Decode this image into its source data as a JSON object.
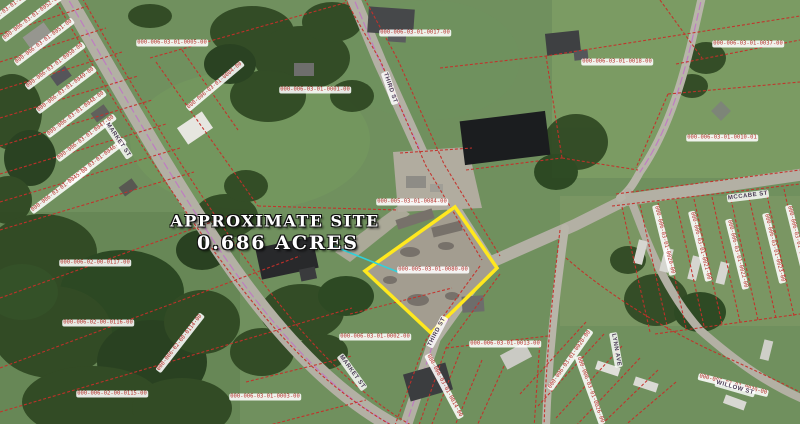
{
  "map": {
    "site_callout": {
      "line1": "APPROXIMATE SITE",
      "line2": "0.686 ACRES"
    },
    "site_parcel_id": "000-005-03-01-0080-00",
    "colors": {
      "highlight": "#ffe81e",
      "parcel_line": "#c5302a",
      "leader": "#2fd2dc",
      "road_centerline": "#c070c8",
      "label_text": "#b5302a"
    },
    "parcel_labels": [
      {
        "text": "000-006-03-01-0053-00",
        "x": 10,
        "y": 8,
        "r": -37
      },
      {
        "text": "000-006-03-01-0052-00",
        "x": 32,
        "y": 18,
        "r": -37
      },
      {
        "text": "000-006-03-01-0051-00",
        "x": 44,
        "y": 42,
        "r": -37
      },
      {
        "text": "000-006-03-01-0050-00",
        "x": 55,
        "y": 66,
        "r": -37
      },
      {
        "text": "000-006-03-01-0049-00",
        "x": 66,
        "y": 90,
        "r": -37
      },
      {
        "text": "000-006-03-01-0048-00",
        "x": 76,
        "y": 114,
        "r": -37
      },
      {
        "text": "000-006-03-01-0047-00",
        "x": 86,
        "y": 138,
        "r": -37
      },
      {
        "text": "000-006-03-01-0046-00",
        "x": 96,
        "y": 162,
        "r": -37
      },
      {
        "text": "000-006-03-01-0045-00",
        "x": 60,
        "y": 190,
        "r": -37
      },
      {
        "text": "000-006-03-01-0005-00",
        "x": 172,
        "y": 43,
        "r": 0
      },
      {
        "text": "000-006-03-01-0004-00",
        "x": 215,
        "y": 86,
        "r": -40
      },
      {
        "text": "000-006-03-01-0001-00",
        "x": 315,
        "y": 90,
        "r": 0
      },
      {
        "text": "000-006-03-01-0017-00",
        "x": 415,
        "y": 33,
        "r": 0
      },
      {
        "text": "000-006-03-01-0018-00",
        "x": 617,
        "y": 62,
        "r": 0
      },
      {
        "text": "000-006-03-01-0037-00",
        "x": 748,
        "y": 44,
        "r": 0
      },
      {
        "text": "000-006-03-01-0010-01",
        "x": 722,
        "y": 138,
        "r": 0
      },
      {
        "text": "000-005-03-01-0084-00",
        "x": 412,
        "y": 202,
        "r": 0
      },
      {
        "text": "000-005-03-01-0080-00",
        "x": 433,
        "y": 270,
        "r": 0
      },
      {
        "text": "000-006-02-00-0117-00",
        "x": 95,
        "y": 263,
        "r": 0
      },
      {
        "text": "000-006-02-00-0116-00",
        "x": 98,
        "y": 323,
        "r": 0
      },
      {
        "text": "000-006-02-00-0115-00",
        "x": 112,
        "y": 394,
        "r": 0
      },
      {
        "text": "000-006-02-00-0114-00",
        "x": 180,
        "y": 343,
        "r": -52
      },
      {
        "text": "000-006-03-01-0003-00",
        "x": 265,
        "y": 397,
        "r": 0
      },
      {
        "text": "000-006-03-01-0002-00",
        "x": 375,
        "y": 337,
        "r": 0
      },
      {
        "text": "000-006-03-01-0013-00",
        "x": 505,
        "y": 344,
        "r": 0
      },
      {
        "text": "000-006-03-01-0020-00",
        "x": 664,
        "y": 240,
        "r": 76
      },
      {
        "text": "000-006-03-01-0021-00",
        "x": 700,
        "y": 246,
        "r": 76
      },
      {
        "text": "000-006-03-01-0022-00",
        "x": 737,
        "y": 254,
        "r": 76
      },
      {
        "text": "000-006-03-01-0023-00",
        "x": 774,
        "y": 248,
        "r": 76
      },
      {
        "text": "000-006-03-01-0024-00",
        "x": 797,
        "y": 240,
        "r": 76
      },
      {
        "text": "000-006-03-01-0014-00",
        "x": 444,
        "y": 386,
        "r": 62
      },
      {
        "text": "000-006-03-01-0026-00",
        "x": 590,
        "y": 390,
        "r": 70
      },
      {
        "text": "000-006-03-01-0028-00",
        "x": 570,
        "y": 360,
        "r": -55
      },
      {
        "text": "000-006-03-01-0030-00",
        "x": 733,
        "y": 385,
        "r": 14
      }
    ],
    "street_labels": [
      {
        "text": "MARKET ST",
        "x": 118,
        "y": 140,
        "r": 56
      },
      {
        "text": "MARKET ST",
        "x": 352,
        "y": 372,
        "r": 54
      },
      {
        "text": "THIRD ST",
        "x": 390,
        "y": 88,
        "r": 71
      },
      {
        "text": "THIRD ST",
        "x": 437,
        "y": 332,
        "r": -62
      },
      {
        "text": "MCCABE ST",
        "x": 748,
        "y": 196,
        "r": -7
      },
      {
        "text": "LYNN AVE",
        "x": 616,
        "y": 350,
        "r": 80
      },
      {
        "text": "WILLOW ST",
        "x": 735,
        "y": 388,
        "r": 16
      }
    ]
  }
}
